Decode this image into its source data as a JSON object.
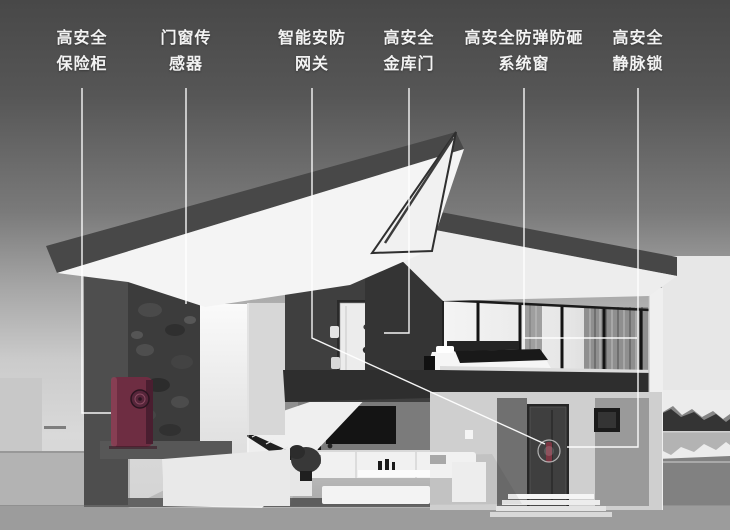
{
  "labels": [
    {
      "id": "high-security-safe",
      "line1": "高安全",
      "line2": "保险柜"
    },
    {
      "id": "door-window-sensor",
      "line1": "门窗传",
      "line2": "感器"
    },
    {
      "id": "smart-security-gateway",
      "line1": "智能安防",
      "line2": "网关"
    },
    {
      "id": "high-security-vault-door",
      "line1": "高安全",
      "line2": "金库门"
    },
    {
      "id": "bulletproof-system-window",
      "line1": "高安全防弹防砸",
      "line2": "系统窗"
    },
    {
      "id": "high-security-vein-lock",
      "line1": "高安全",
      "line2": "静脉锁"
    }
  ],
  "colors": {
    "label_text": "#f3f3f3",
    "leader_line": "#ffffff",
    "safe_body": "#6e2d42",
    "door_lock_accent": "#7b3642",
    "sky_top": "#484848",
    "sky_bottom": "#d9d9d9",
    "ground": "#9c9c9c"
  }
}
